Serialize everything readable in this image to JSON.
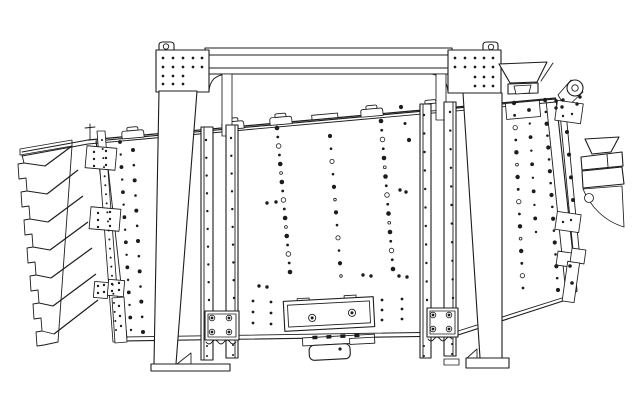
{
  "title": "engineering-line-drawing",
  "subject": "gyratory-screening-machine-side-elevation",
  "colors": {
    "ink": "#1c1c1c",
    "paper": "#ffffff"
  },
  "components": [
    "support-frame-beam",
    "lifting-eye-left",
    "lifting-eye-right",
    "lifting-eye-end",
    "frame-leg-left",
    "frame-leg-right",
    "foot-left",
    "foot-right",
    "screen-body",
    "top-rail",
    "clamp-tabs",
    "inlet-hopper",
    "discharge-stack-left",
    "discharge-chute-right",
    "gusset-plate",
    "hanger-channel-left",
    "hanger-channel-right",
    "hanger-plate-4bolt",
    "access-panel",
    "drive-unit",
    "end-wall",
    "outboard-hanger-left"
  ],
  "counts": {
    "discharge_spouts_left": 7,
    "clamp_tabs": 5,
    "hanger_assemblies": 2,
    "lifting_eyes": 3
  },
  "drawing": {
    "rivet_columns": [
      {
        "x0": 277,
        "y0": 128,
        "x1": 290,
        "y1": 272,
        "n": 17,
        "r": 1.4,
        "alt": 2.3,
        "ring": true
      },
      {
        "x0": 330,
        "y0": 136,
        "x1": 341,
        "y1": 276,
        "n": 12,
        "r": 1.3,
        "alt": 2.1,
        "ring": true
      },
      {
        "x0": 381,
        "y0": 121,
        "x1": 393,
        "y1": 269,
        "n": 17,
        "r": 1.4,
        "alt": 2.3,
        "ring": true
      },
      {
        "x0": 401,
        "y0": 107,
        "x1": 409,
        "y1": 140,
        "n": 3,
        "r": 1.5,
        "alt": 2.1
      },
      {
        "x0": 514,
        "y0": 103,
        "x1": 523,
        "y1": 288,
        "n": 16,
        "r": 1.4,
        "alt": 2.2,
        "ring": true
      },
      {
        "x0": 529,
        "y0": 110,
        "x1": 536,
        "y1": 232,
        "n": 10,
        "r": 1.2,
        "alt": 1.9
      },
      {
        "x0": 545,
        "y0": 100,
        "x1": 558,
        "y1": 290,
        "n": 17,
        "r": 1.3,
        "alt": 2.1
      },
      {
        "x0": 120,
        "y0": 142,
        "x1": 131,
        "y1": 330,
        "n": 16,
        "r": 1.2,
        "alt": 1.9
      },
      {
        "x0": 133,
        "y0": 150,
        "x1": 143,
        "y1": 332,
        "n": 13,
        "r": 1.3,
        "alt": 2.0
      },
      {
        "x0": 102,
        "y0": 140,
        "x1": 116,
        "y1": 330,
        "n": 22,
        "r": 1.0,
        "alt": 1.0
      },
      {
        "x0": 206,
        "y0": 140,
        "x1": 209,
        "y1": 300,
        "n": 10,
        "r": 1.2,
        "alt": 1.2
      },
      {
        "x0": 231,
        "y0": 138,
        "x1": 234,
        "y1": 298,
        "n": 10,
        "r": 1.2,
        "alt": 1.2
      },
      {
        "x0": 424,
        "y0": 115,
        "x1": 427,
        "y1": 300,
        "n": 11,
        "r": 1.2,
        "alt": 1.2
      },
      {
        "x0": 450,
        "y0": 112,
        "x1": 453,
        "y1": 298,
        "n": 11,
        "r": 1.2,
        "alt": 1.2
      },
      {
        "x0": 253,
        "y0": 301,
        "x1": 253,
        "y1": 323,
        "n": 3,
        "r": 1.4,
        "alt": 1.4
      },
      {
        "x0": 271,
        "y0": 302,
        "x1": 271,
        "y1": 324,
        "n": 3,
        "r": 1.4,
        "alt": 1.4
      },
      {
        "x0": 382,
        "y0": 300,
        "x1": 382,
        "y1": 320,
        "n": 3,
        "r": 1.4,
        "alt": 1.4
      },
      {
        "x0": 402,
        "y0": 299,
        "x1": 402,
        "y1": 319,
        "n": 3,
        "r": 1.4,
        "alt": 1.4
      },
      {
        "x0": 207,
        "y0": 346,
        "x1": 207,
        "y1": 356,
        "n": 2,
        "r": 1.0,
        "alt": 1.0
      },
      {
        "x0": 233,
        "y0": 345,
        "x1": 233,
        "y1": 355,
        "n": 2,
        "r": 1.0,
        "alt": 1.0
      },
      {
        "x0": 424,
        "y0": 346,
        "x1": 424,
        "y1": 356,
        "n": 2,
        "r": 1.0,
        "alt": 1.0
      },
      {
        "x0": 452,
        "y0": 344,
        "x1": 452,
        "y1": 354,
        "n": 2,
        "r": 1.0,
        "alt": 1.0
      },
      {
        "x0": 567,
        "y0": 132,
        "x1": 573,
        "y1": 200,
        "n": 4,
        "r": 2.0,
        "alt": 2.0
      },
      {
        "x0": 570,
        "y0": 266,
        "x1": 572,
        "y1": 283,
        "n": 2,
        "r": 1.8,
        "alt": 1.8
      }
    ],
    "singles": [
      [
        267,
        203
      ],
      [
        276,
        202
      ],
      [
        363,
        275
      ],
      [
        371,
        276
      ],
      [
        259,
        286
      ],
      [
        267,
        287
      ],
      [
        399,
        276
      ],
      [
        407,
        277
      ],
      [
        400,
        190
      ],
      [
        406,
        192
      ],
      [
        556,
        101
      ],
      [
        563,
        100
      ],
      [
        556,
        108
      ],
      [
        562,
        107
      ],
      [
        577,
        104
      ],
      [
        580,
        97
      ]
    ],
    "cap_bolts": [
      [
        163,
        58
      ],
      [
        173,
        58
      ],
      [
        183,
        58
      ],
      [
        193,
        58
      ],
      [
        202,
        58
      ],
      [
        163,
        67
      ],
      [
        173,
        67
      ],
      [
        183,
        67
      ],
      [
        193,
        67
      ],
      [
        202,
        67
      ],
      [
        163,
        76
      ],
      [
        173,
        76
      ],
      [
        183,
        76
      ],
      [
        163,
        84
      ],
      [
        173,
        84
      ],
      [
        183,
        84
      ],
      [
        455,
        58
      ],
      [
        465,
        58
      ],
      [
        475,
        58
      ],
      [
        484,
        58
      ],
      [
        493,
        58
      ],
      [
        455,
        67
      ],
      [
        465,
        67
      ],
      [
        475,
        67
      ],
      [
        484,
        67
      ],
      [
        493,
        67
      ],
      [
        475,
        77
      ],
      [
        484,
        77
      ],
      [
        493,
        77
      ],
      [
        475,
        86
      ],
      [
        484,
        86
      ],
      [
        493,
        86
      ]
    ],
    "bracket_bolts": [
      [
        94,
        152
      ],
      [
        106,
        151
      ],
      [
        94,
        159
      ],
      [
        106,
        158
      ],
      [
        94,
        166
      ],
      [
        106,
        165
      ],
      [
        98,
        213
      ],
      [
        110,
        212
      ],
      [
        98,
        220
      ],
      [
        110,
        219
      ],
      [
        98,
        227
      ],
      [
        110,
        226
      ],
      [
        98,
        286
      ],
      [
        104,
        285
      ],
      [
        98,
        293
      ],
      [
        104,
        292
      ],
      [
        112,
        284
      ],
      [
        119,
        283
      ],
      [
        112,
        291
      ],
      [
        119,
        290
      ],
      [
        119,
        306
      ],
      [
        120,
        316
      ],
      [
        121,
        326
      ],
      [
        563,
        116
      ],
      [
        572,
        114
      ],
      [
        563,
        222
      ],
      [
        571,
        220
      ]
    ],
    "flange_bolts": [
      [
        212,
        318
      ],
      [
        229,
        318
      ],
      [
        212,
        332
      ],
      [
        229,
        332
      ],
      [
        433,
        315
      ],
      [
        449,
        315
      ],
      [
        433,
        329
      ],
      [
        449,
        329
      ]
    ],
    "knobs": [
      [
        312,
        317
      ],
      [
        352,
        314
      ]
    ]
  }
}
